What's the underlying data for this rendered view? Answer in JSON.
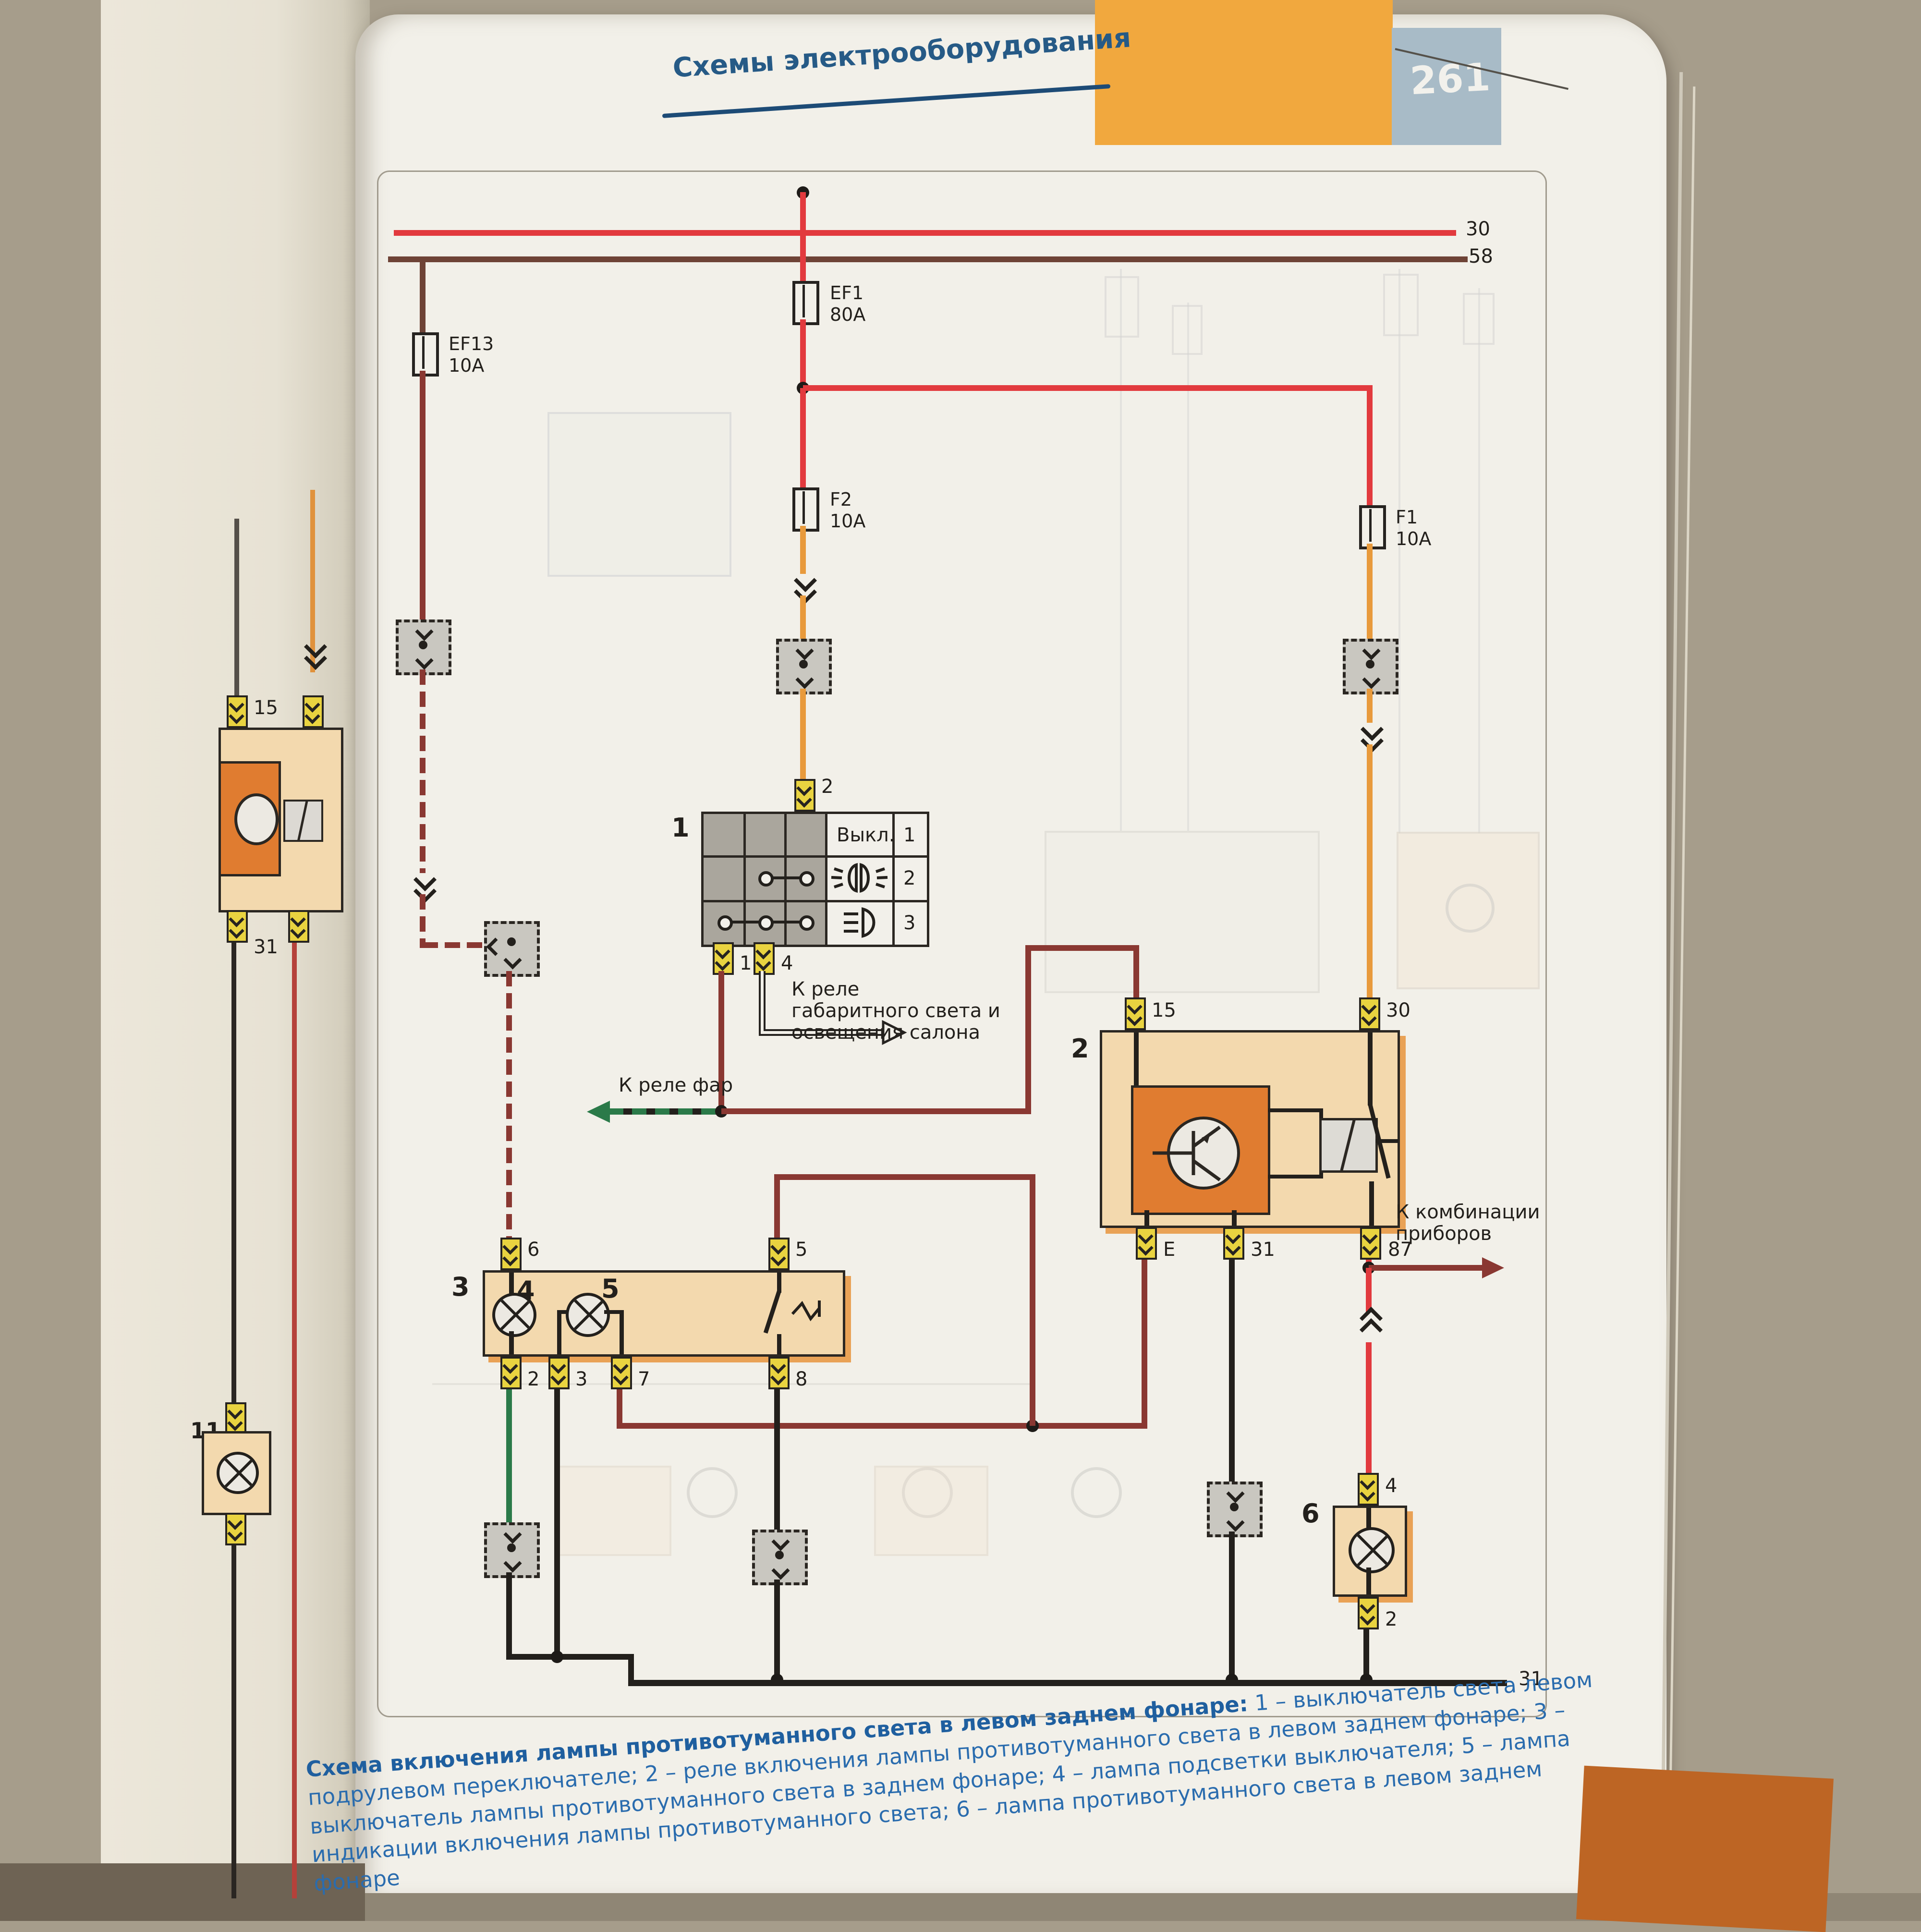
{
  "header": {
    "title": "Схемы электрооборудования",
    "page_number": "261"
  },
  "buses": {
    "b30": "30",
    "b58": "58",
    "b31": "31"
  },
  "fuses": {
    "ef13": {
      "name": "EF13",
      "rating": "10A"
    },
    "ef1": {
      "name": "EF1",
      "rating": "80A"
    },
    "f2": {
      "name": "F2",
      "rating": "10A"
    },
    "f1": {
      "name": "F1",
      "rating": "10A"
    }
  },
  "component1": {
    "number": "1",
    "state_off": "Выкл.",
    "row_nums": [
      "1",
      "2",
      "3"
    ],
    "pin_top": "2",
    "pin_bl": "1",
    "pin_br": "4"
  },
  "component2": {
    "number": "2",
    "pin15": "15",
    "pin30": "30",
    "pinE": "E",
    "pin31": "31",
    "pin87": "87"
  },
  "component3": {
    "number": "3",
    "lamp4": "4",
    "lamp5": "5",
    "pin6": "6",
    "pin5": "5",
    "pin2": "2",
    "pin3": "3",
    "pin7": "7",
    "pin8": "8"
  },
  "component6": {
    "number": "6",
    "pin4": "4",
    "pin2": "2"
  },
  "annotations": {
    "to_headlight_relay": "К реле фар",
    "to_marker_relay_l1": "К реле",
    "to_marker_relay_l2": "габаритного света и",
    "to_marker_relay_l3": "освещения салона",
    "to_cluster_l1": "К комбинации",
    "to_cluster_l2": "приборов"
  },
  "left_page": {
    "pin15": "15",
    "pin31": "31",
    "comp11": "11"
  },
  "caption": {
    "bold": "Схема включения лампы противотуманного света в левом заднем фонаре:",
    "rest": " 1 – выключатель света левом подрулевом переключателе; 2 – реле включения лампы противотуманного света в левом заднем фонаре; 3 – выключатель лампы противотуманного света в заднем фонаре; 4 – лампа подсветки выключателя; 5 – лампа индикации включения лампы противотуманного света; 6 – лампа противотуманного света в левом заднем фонаре"
  }
}
